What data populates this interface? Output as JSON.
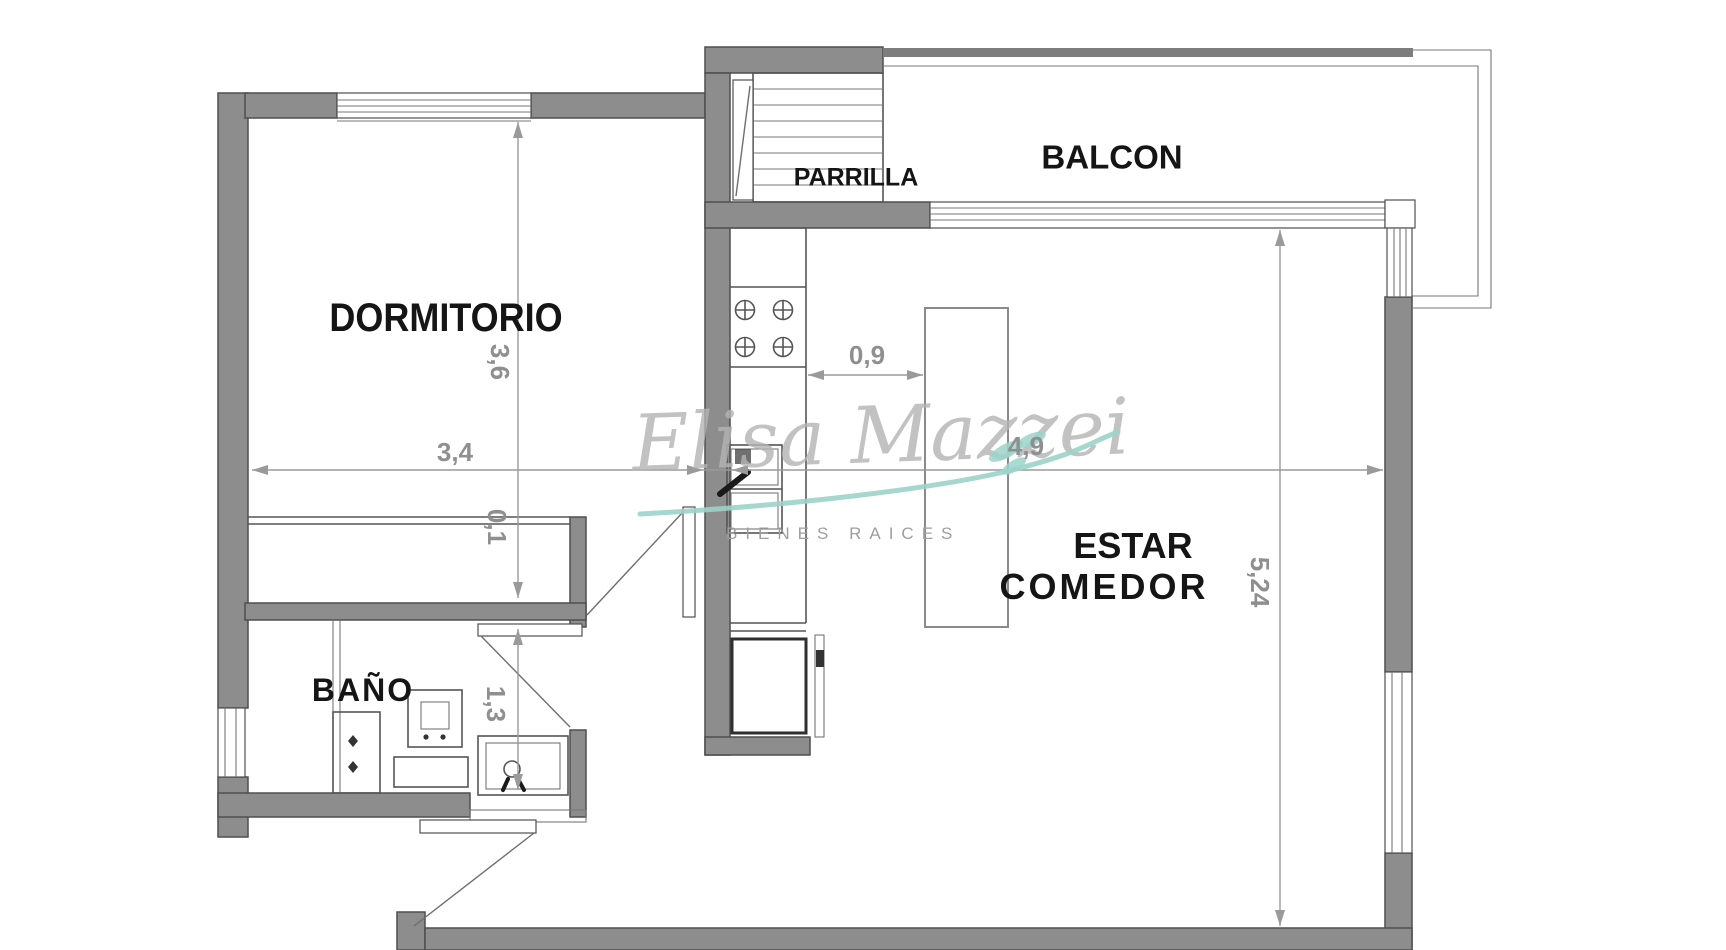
{
  "rooms": {
    "bedroom": "DORMITORIO",
    "bathroom": "BAÑO",
    "living_dining_line1": "ESTAR",
    "living_dining_line2": "COMEDOR",
    "balcony": "BALCON",
    "grill": "PARRILLA"
  },
  "dimensions": {
    "bedroom_width": "3,4",
    "bedroom_depth": "3,6",
    "closet_depth": "0,1",
    "bathroom_length": "1,3",
    "kitchen_clearance": "0,9",
    "living_width": "4,9",
    "living_depth": "5,24"
  },
  "watermark": {
    "brand": "Elisa Mazzei",
    "tagline": "BIENES RAICES"
  },
  "colors": {
    "wall_fill": "#8d8d8d",
    "wall_outline": "#4f4f4f",
    "fixture_line": "#555555",
    "dim_line": "#9a9a9a",
    "dim_text": "#8f8f8f",
    "label_text": "#151515",
    "watermark_text": "#b4b4b4",
    "tagline_text": "#9e9e9e",
    "accent_teal": "#9bd3ca"
  }
}
